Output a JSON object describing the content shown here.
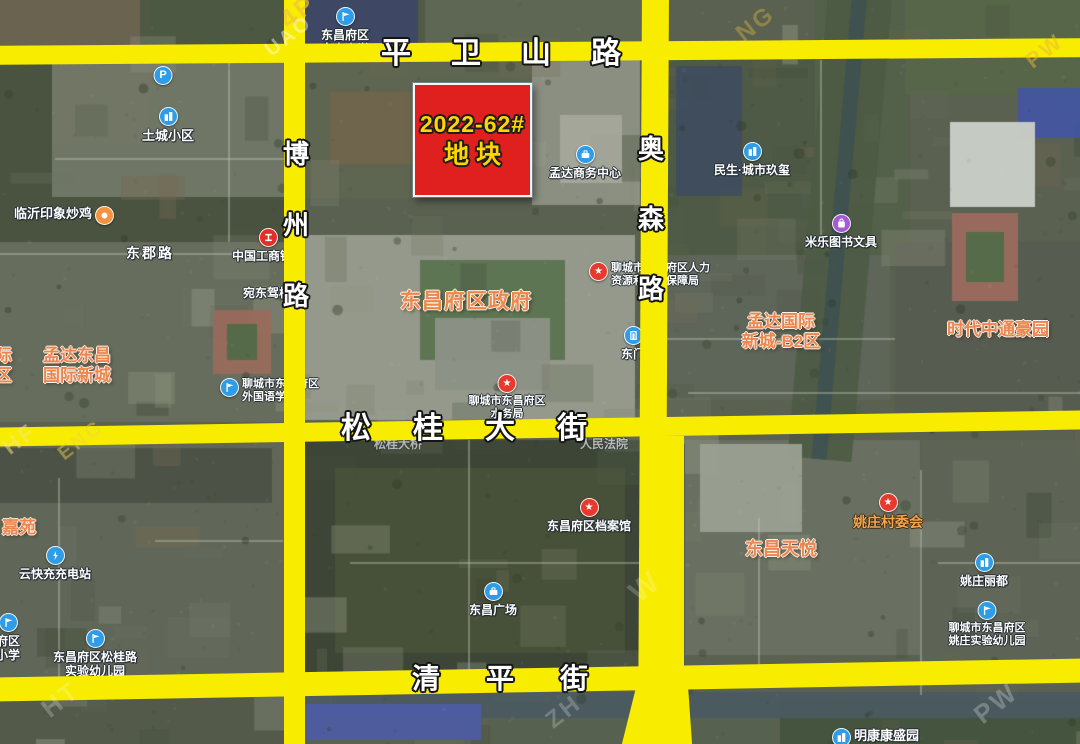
{
  "map_title": "2022-62# parcel location satellite map",
  "parcel": {
    "x": 413,
    "y": 83,
    "width": 115,
    "height": 110,
    "line1": "2022-62#",
    "line2": "地块",
    "fill": "#e01f1f",
    "text_color": "#ffd400",
    "border_color": "#ffffff"
  },
  "roads": {
    "color": "#f8ec00",
    "horizontal": [
      {
        "id": "road-pingweishan",
        "name": "平卫山路",
        "chars": [
          "平",
          "卫",
          "山",
          "路"
        ],
        "band": {
          "top": 42,
          "height": 19,
          "rotate": -0.4
        },
        "label": {
          "cx": 501,
          "cy": 54,
          "size": 30,
          "gap": 40
        }
      },
      {
        "id": "road-songgui",
        "name": "松桂大街",
        "chars": [
          "松",
          "桂",
          "大",
          "街"
        ],
        "band": {
          "top": 419,
          "height": 19,
          "rotate": -0.9
        },
        "label": {
          "cx": 464,
          "cy": 429,
          "size": 30,
          "gap": 42
        }
      },
      {
        "id": "road-qingping",
        "name": "清平街",
        "chars": [
          "清",
          "平",
          "街"
        ],
        "band": {
          "top": 668,
          "height": 24,
          "rotate": -1
        },
        "label": {
          "cx": 500,
          "cy": 679,
          "size": 28,
          "gap": 46
        }
      }
    ],
    "vertical": [
      {
        "id": "road-bozhou",
        "name": "博州路",
        "chars": [
          "博",
          "州",
          "路"
        ],
        "band": {
          "left": 284,
          "width": 21,
          "rotate": 0
        },
        "label": {
          "cx": 296,
          "cy": 225,
          "size": 26,
          "gap": 45
        }
      },
      {
        "id": "road-aosen",
        "name": "奥森路",
        "chars": [
          "奥",
          "森",
          "路"
        ],
        "band": {
          "left": 640,
          "width": 27,
          "rotate": 0.3
        },
        "label": {
          "cx": 651,
          "cy": 219,
          "size": 26,
          "gap": 44
        }
      }
    ],
    "segments": [
      {
        "id": "road-aosen-lower",
        "left": 650,
        "top": 436,
        "width": 34,
        "height": 256,
        "rotate": 0
      },
      {
        "id": "road-aosen-fork-left",
        "left": 629,
        "top": 684,
        "width": 24,
        "height": 66,
        "rotate": 14
      },
      {
        "id": "road-aosen-fork-right",
        "left": 656,
        "top": 684,
        "width": 34,
        "height": 62,
        "rotate": -4
      }
    ]
  },
  "pois": [
    {
      "id": "poi-aosen-primary-school",
      "cx": 345,
      "top": 7,
      "arrange": "icon-top",
      "icon": {
        "shape": "flag",
        "color": "#2e9ce6"
      },
      "lines": [
        "东昌府区",
        "奥森小学"
      ],
      "style": "white",
      "interactable": true
    },
    {
      "id": "poi-parking",
      "cx": 163,
      "top": 66,
      "arrange": "icon-top",
      "icon": {
        "shape": "p",
        "color": "#2e9ce6"
      },
      "lines": [],
      "style": "white",
      "interactable": true
    },
    {
      "id": "poi-tucheng-estate",
      "cx": 168,
      "top": 107,
      "arrange": "icon-top",
      "icon": {
        "shape": "building",
        "color": "#2e9ce6"
      },
      "lines": [
        "土城小区"
      ],
      "style": "white",
      "size": 13,
      "interactable": true
    },
    {
      "id": "poi-linyi-fried-chicken",
      "left": 14,
      "top": 206,
      "arrange": "icon-right",
      "icon": {
        "shape": "food",
        "color": "#f5923e"
      },
      "lines": [
        "临沂印象炒鸡"
      ],
      "style": "white",
      "size": 13,
      "interactable": true
    },
    {
      "id": "label-dongjun-road",
      "cx": 150,
      "top": 245,
      "arrange": "text-only",
      "lines": [
        "东郡路"
      ],
      "style": "white",
      "size": 14,
      "spacing": 2,
      "interactable": false
    },
    {
      "id": "poi-icbc-bank",
      "cx": 268,
      "top": 228,
      "arrange": "icon-top",
      "icon": {
        "shape": "bank",
        "color": "#e23028"
      },
      "lines": [
        "中国工商银行"
      ],
      "style": "white",
      "interactable": true
    },
    {
      "id": "label-wandong-driving-school",
      "cx": 267,
      "top": 286,
      "arrange": "text-only",
      "lines": [
        "宛东驾校"
      ],
      "style": "white",
      "interactable": false
    },
    {
      "id": "label-mengda-dongchang-estate",
      "cx": 77,
      "top": 346,
      "arrange": "text-only",
      "lines": [
        "孟达东昌",
        "国际新城"
      ],
      "style": "orange",
      "size": 17,
      "interactable": false
    },
    {
      "id": "label-edge-estate-left",
      "left": -5,
      "top": 346,
      "arrange": "text-only",
      "lines": [
        "际",
        "区"
      ],
      "style": "orange",
      "size": 17,
      "interactable": false
    },
    {
      "id": "poi-foreign-language-school",
      "left": 220,
      "top": 378,
      "arrange": "icon-left",
      "icon": {
        "shape": "flag",
        "color": "#2e9ce6"
      },
      "lines": [
        "聊城市东昌府区",
        "外国语学校"
      ],
      "style": "white-sm",
      "interactable": true
    },
    {
      "id": "label-district-government",
      "cx": 466,
      "top": 289,
      "arrange": "text-only",
      "lines": [
        "东昌府区政府"
      ],
      "style": "orange-big",
      "interactable": false
    },
    {
      "id": "poi-hrss-bureau",
      "left": 589,
      "top": 262,
      "arrange": "icon-left",
      "icon": {
        "shape": "star",
        "color": "#e8392e"
      },
      "lines": [
        "聊城市东昌府区人力",
        "资源和社会保障局"
      ],
      "style": "white-sm",
      "interactable": true
    },
    {
      "id": "poi-mengda-business-center",
      "cx": 585,
      "top": 145,
      "arrange": "icon-top",
      "icon": {
        "shape": "briefcase",
        "color": "#2e9ce6"
      },
      "lines": [
        "孟达商务中心"
      ],
      "style": "white",
      "interactable": true
    },
    {
      "id": "poi-minsheng-estate",
      "cx": 752,
      "top": 142,
      "arrange": "icon-top",
      "icon": {
        "shape": "building",
        "color": "#2e9ce6"
      },
      "lines": [
        "民生·城市玖玺"
      ],
      "style": "white",
      "interactable": true
    },
    {
      "id": "poi-mile-books-stationery",
      "cx": 841,
      "top": 214,
      "arrange": "icon-top",
      "icon": {
        "shape": "bag",
        "color": "#a45ad6"
      },
      "lines": [
        "米乐图书文具"
      ],
      "style": "white",
      "interactable": true
    },
    {
      "id": "label-mengda-b2-estate",
      "cx": 781,
      "top": 312,
      "arrange": "text-only",
      "lines": [
        "孟达国际",
        "新城-B2区"
      ],
      "style": "orange",
      "size": 17,
      "interactable": false
    },
    {
      "id": "label-shidai-zhongtong-estate",
      "cx": 998,
      "top": 320,
      "arrange": "text-only",
      "lines": [
        "时代中通豪园"
      ],
      "style": "orange",
      "size": 17,
      "interactable": false
    },
    {
      "id": "poi-east-gate",
      "cx": 633,
      "top": 326,
      "arrange": "icon-top",
      "icon": {
        "shape": "door",
        "color": "#2e9ce6"
      },
      "lines": [
        "东门"
      ],
      "style": "white",
      "interactable": true
    },
    {
      "id": "poi-water-bureau",
      "cx": 507,
      "top": 374,
      "arrange": "icon-top",
      "icon": {
        "shape": "star",
        "color": "#e8392e"
      },
      "lines": [
        "聊城市东昌府区",
        "水务局"
      ],
      "style": "white-sm",
      "interactable": true
    },
    {
      "id": "label-songgui-bridge",
      "cx": 398,
      "top": 437,
      "arrange": "text-only",
      "lines": [
        "松桂大桥"
      ],
      "style": "faint",
      "interactable": false
    },
    {
      "id": "label-peoples-court",
      "cx": 604,
      "top": 437,
      "arrange": "text-only",
      "lines": [
        "人民法院"
      ],
      "style": "faint",
      "interactable": false
    },
    {
      "id": "poi-district-archives",
      "cx": 589,
      "top": 498,
      "arrange": "icon-top",
      "icon": {
        "shape": "star",
        "color": "#e8392e"
      },
      "lines": [
        "东昌府区档案馆"
      ],
      "style": "white",
      "interactable": true
    },
    {
      "id": "poi-dongchang-square",
      "cx": 493,
      "top": 582,
      "arrange": "icon-top",
      "icon": {
        "shape": "briefcase",
        "color": "#2e9ce6"
      },
      "lines": [
        "东昌广场"
      ],
      "style": "white",
      "interactable": true
    },
    {
      "id": "label-jiayuan-estate",
      "left": 2,
      "top": 518,
      "arrange": "text-only",
      "lines": [
        "嘉苑"
      ],
      "style": "orange",
      "size": 17,
      "interactable": false
    },
    {
      "id": "poi-ev-charging-station",
      "cx": 55,
      "top": 546,
      "arrange": "icon-top",
      "icon": {
        "shape": "charge",
        "color": "#2e9ce6"
      },
      "lines": [
        "云快充充电站"
      ],
      "style": "white",
      "interactable": true
    },
    {
      "id": "poi-edge-school-left",
      "cx": 8,
      "top": 613,
      "arrange": "icon-top",
      "icon": {
        "shape": "flag",
        "color": "#2e9ce6"
      },
      "lines": [
        "府区",
        "小学"
      ],
      "style": "white",
      "interactable": true
    },
    {
      "id": "poi-songgui-kindergarten",
      "cx": 95,
      "top": 629,
      "arrange": "icon-top",
      "icon": {
        "shape": "flag",
        "color": "#2e9ce6"
      },
      "lines": [
        "东昌府区松桂路",
        "实验幼儿园"
      ],
      "style": "white",
      "interactable": true
    },
    {
      "id": "label-dongchang-tianyue-estate",
      "cx": 781,
      "top": 539,
      "arrange": "text-only",
      "lines": [
        "东昌天悦"
      ],
      "style": "orange",
      "size": 18,
      "interactable": false
    },
    {
      "id": "poi-yaozhuang-village-committee",
      "cx": 888,
      "top": 493,
      "arrange": "icon-top",
      "icon": {
        "shape": "star",
        "color": "#e8392e"
      },
      "lines": [
        "姚庄村委会"
      ],
      "style": "amber",
      "interactable": true
    },
    {
      "id": "poi-yaozhuang-lidu-estate",
      "cx": 984,
      "top": 553,
      "arrange": "icon-top",
      "icon": {
        "shape": "building",
        "color": "#2e9ce6"
      },
      "lines": [
        "姚庄丽都"
      ],
      "style": "white",
      "interactable": true
    },
    {
      "id": "poi-yaozhuang-kindergarten",
      "cx": 987,
      "top": 601,
      "arrange": "icon-top",
      "icon": {
        "shape": "flag",
        "color": "#2e9ce6"
      },
      "lines": [
        "聊城市东昌府区",
        "姚庄实验幼儿园"
      ],
      "style": "white-sm",
      "interactable": true
    },
    {
      "id": "poi-mingkang-estate",
      "left": 832,
      "top": 728,
      "arrange": "icon-left",
      "icon": {
        "shape": "building",
        "color": "#2e9ce6"
      },
      "lines": [
        "明康康盛园"
      ],
      "style": "white",
      "size": 13,
      "interactable": true
    }
  ],
  "watermarks": [
    {
      "text": "4P",
      "x": 279,
      "y": -2,
      "size": 26,
      "color": "#f0c43c",
      "opacity": 0.7
    },
    {
      "text": "UAO",
      "x": 262,
      "y": 26,
      "size": 20,
      "color": "#ffffff",
      "opacity": 0.45
    },
    {
      "text": "NG",
      "x": 735,
      "y": 12,
      "size": 24,
      "color": "#f0c43c",
      "opacity": 0.35
    },
    {
      "text": "PW",
      "x": 1024,
      "y": 40,
      "size": 22,
      "color": "#e8b83c",
      "opacity": 0.5
    },
    {
      "text": "HF",
      "x": 2,
      "y": 428,
      "size": 22,
      "color": "#f6e98a",
      "opacity": 0.5
    },
    {
      "text": "ENG",
      "x": 55,
      "y": 430,
      "size": 20,
      "color": "#f0d24c",
      "opacity": 0.45
    },
    {
      "text": "W",
      "x": 630,
      "y": 572,
      "size": 30,
      "color": "#ffffff",
      "opacity": 0.2
    },
    {
      "text": "HT",
      "x": 40,
      "y": 686,
      "size": 26,
      "color": "#ffffff",
      "opacity": 0.22
    },
    {
      "text": "ZH",
      "x": 545,
      "y": 700,
      "size": 24,
      "color": "#ffffff",
      "opacity": 0.22
    },
    {
      "text": "PW",
      "x": 972,
      "y": 690,
      "size": 26,
      "color": "#ffffff",
      "opacity": 0.25
    }
  ]
}
